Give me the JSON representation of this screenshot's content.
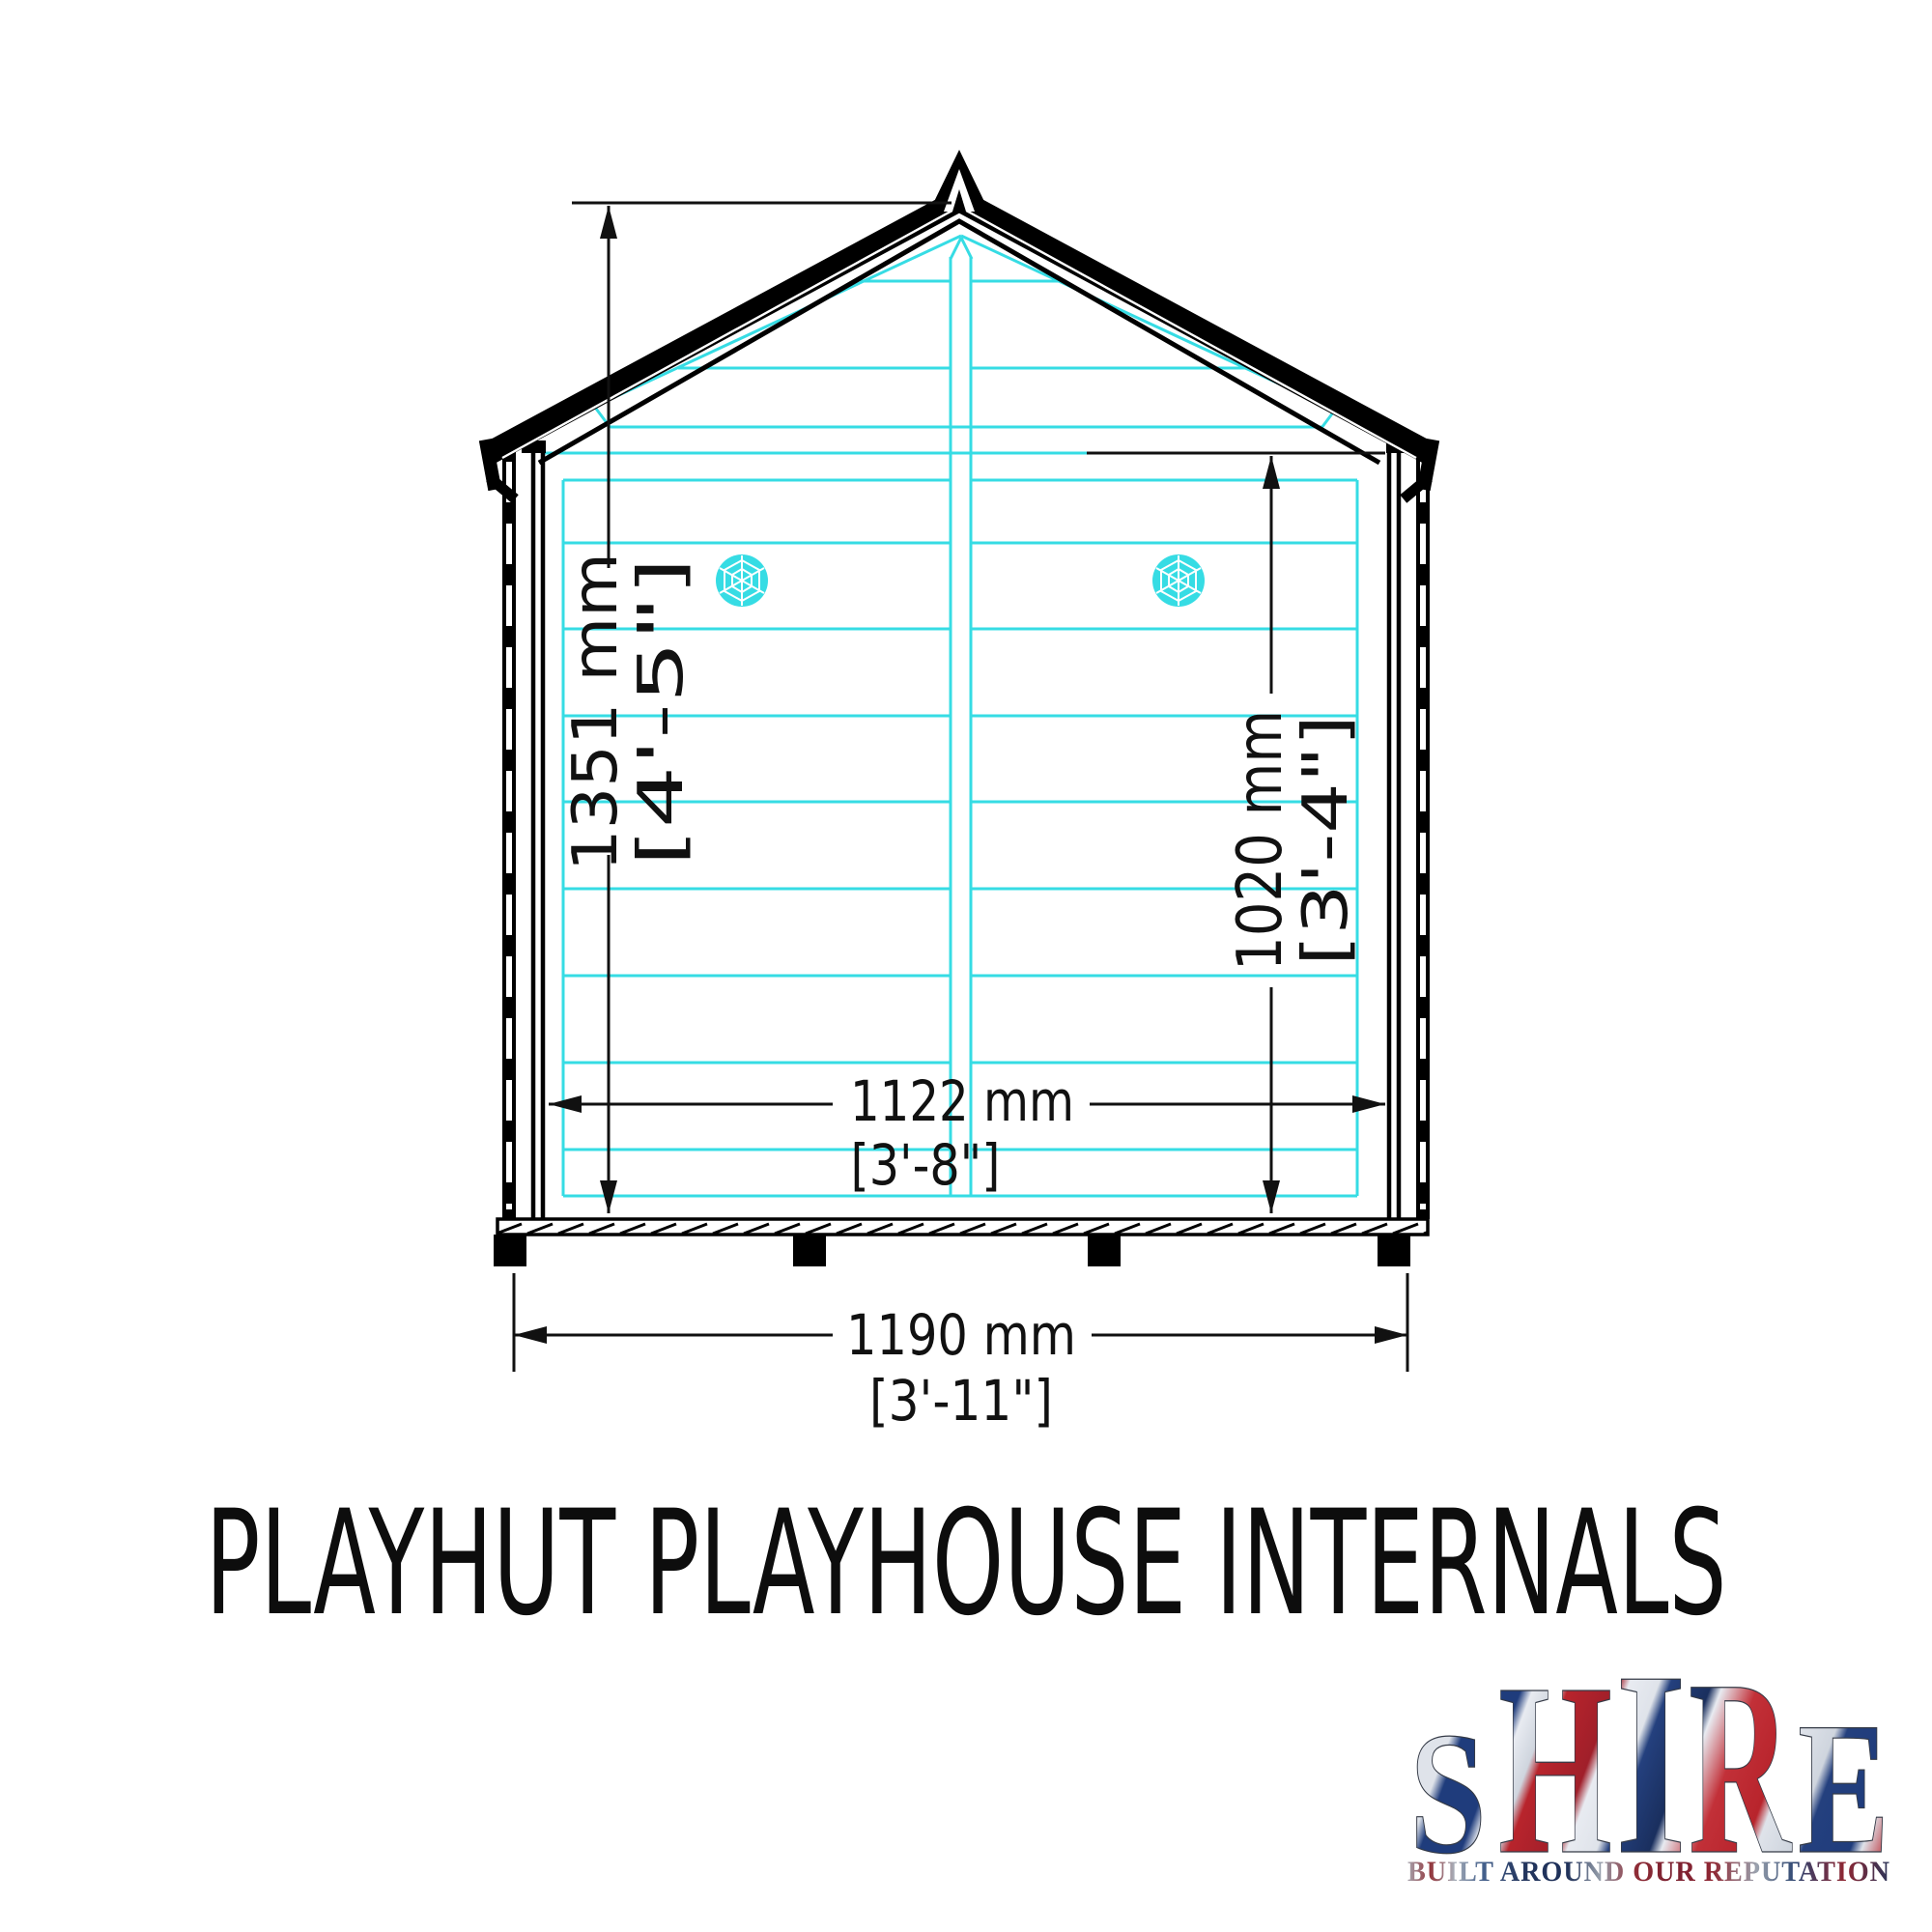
{
  "title": "PLAYHUT PLAYHOUSE INTERNALS",
  "drawing": {
    "dim_overall_height": {
      "metric": "1351 mm",
      "imperial": "[4'-5\"]"
    },
    "dim_internal_wall_height": {
      "metric": "1020 mm",
      "imperial": "[3'-4\"]"
    },
    "dim_internal_width": {
      "metric": "1122 mm",
      "imperial": "[3'-8\"]"
    },
    "dim_overall_width": {
      "metric": "1190 mm",
      "imperial": "[3'-11\"]"
    }
  },
  "logo": {
    "brand": "SHIRE",
    "letters": [
      "S",
      "H",
      "I",
      "R",
      "E"
    ],
    "tagline": "BUILT AROUND OUR REPUTATION"
  },
  "colors": {
    "panel_line_cyan": "#36dce4",
    "drawing_black": "#000000",
    "logo_red": "#b02430",
    "logo_blue": "#203d75",
    "logo_silver": "#d8dce3"
  }
}
